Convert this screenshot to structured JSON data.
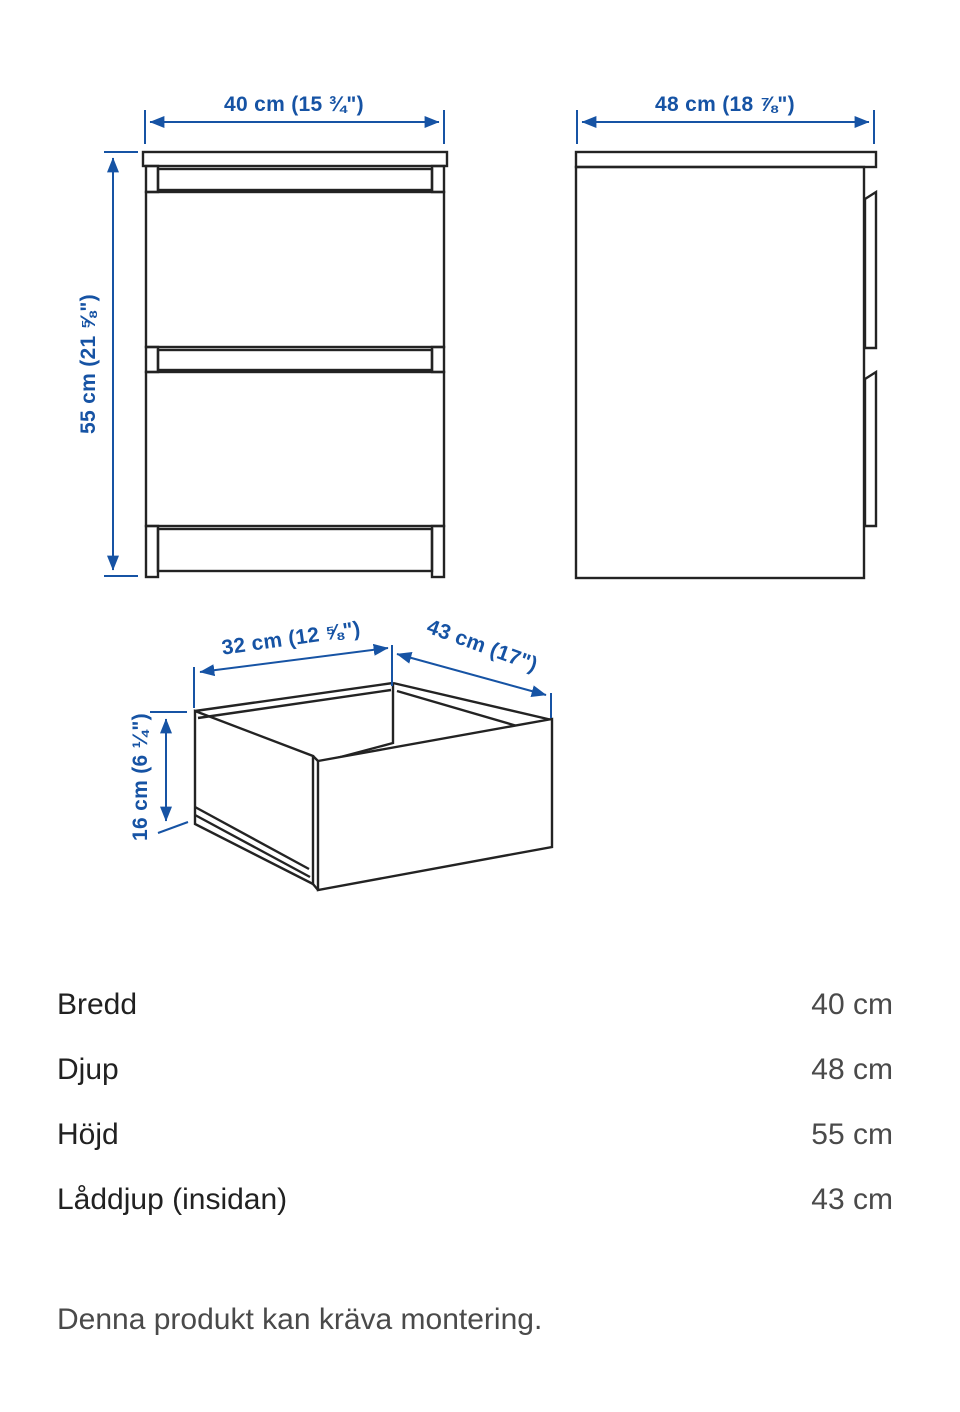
{
  "colors": {
    "dimension_blue": "#1653a4",
    "drawing_line": "#232323",
    "label_dark": "#212121",
    "value_gray": "#4a4a4a"
  },
  "dimension_labels": {
    "front_width": "40 cm (15 ¾\")",
    "front_height": "55 cm (21 ⅝\")",
    "side_depth": "48 cm (18 ⅞\")",
    "drawer_width": "32 cm (12 ⅝\")",
    "drawer_depth": "43 cm (17\")",
    "drawer_height": "16 cm (6 ¼\")"
  },
  "measurements": {
    "rows": [
      {
        "label": "Bredd",
        "value": "40 cm"
      },
      {
        "label": "Djup",
        "value": "48 cm"
      },
      {
        "label": "Höjd",
        "value": "55 cm"
      },
      {
        "label": "Låddjup (insidan)",
        "value": "43 cm"
      }
    ]
  },
  "assembly_note": "Denna produkt kan kräva montering."
}
